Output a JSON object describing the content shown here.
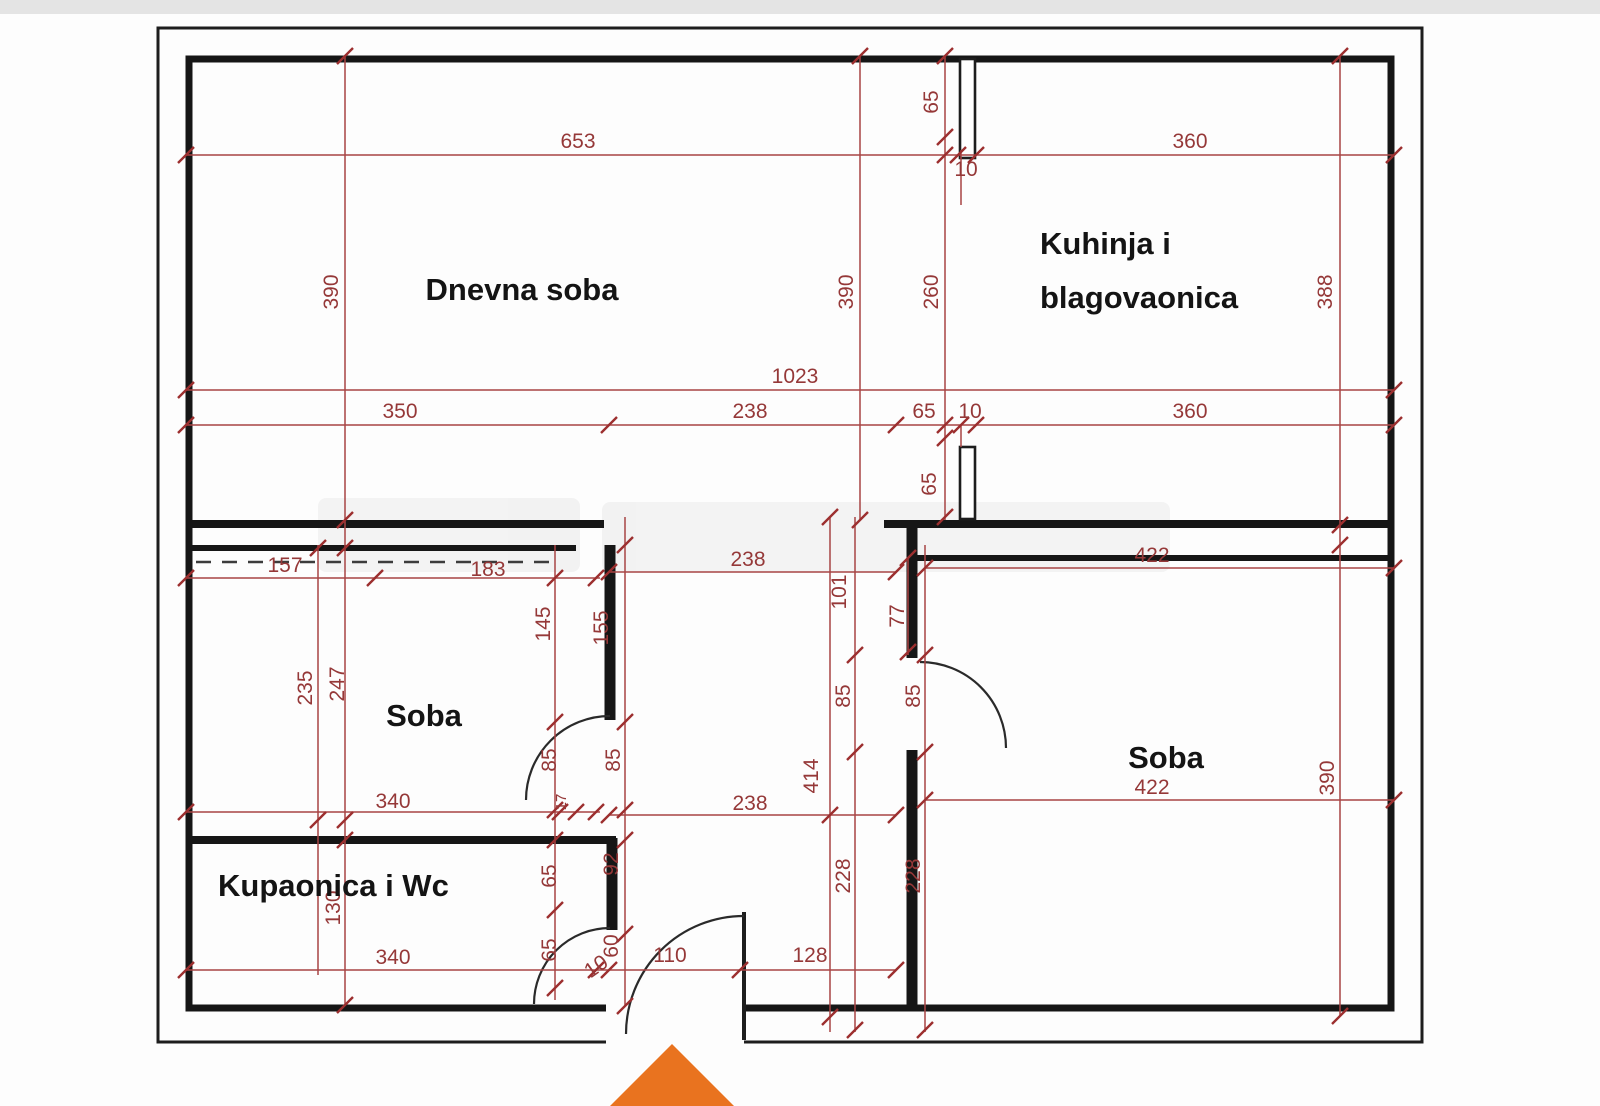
{
  "rooms": {
    "living": "Dnevna soba",
    "kitchen_line1": "Kuhinja i",
    "kitchen_line2": "blagovaonica",
    "room_left": "Soba",
    "room_right": "Soba",
    "bathroom": "Kupaonica i Wc"
  },
  "dimensions": {
    "top_row": {
      "left": "653",
      "right": "360",
      "vent_h": "65",
      "vent_w": "10"
    },
    "upper_heights": {
      "left": "390",
      "mid": "390",
      "kitchen": "260",
      "right": "388"
    },
    "mid_row": {
      "total": "1023",
      "a": "350",
      "b": "238",
      "c": "65",
      "d": "10",
      "e": "360",
      "vent2_h": "65"
    },
    "lower_top_row": {
      "a": "157",
      "b": "183",
      "c": "238",
      "d": "422",
      "hall": "101",
      "wall": "77"
    },
    "left_room": {
      "wall_a": "145",
      "wall_b": "155",
      "h1": "235",
      "h2": "247",
      "door_a": "85",
      "door_b": "85"
    },
    "hall": {
      "len": "414",
      "door_a": "85",
      "door_b": "85"
    },
    "lower_mid_row": {
      "a": "340",
      "b": "17",
      "c": "238",
      "d": "422"
    },
    "right_room": {
      "height": "390",
      "w228a": "228",
      "w228b": "228"
    },
    "bath": {
      "h": "130",
      "w65a": "65",
      "w92": "92",
      "w65b": "65",
      "w60": "60"
    },
    "bottom_row": {
      "a": "340",
      "b": "10",
      "c": "110",
      "d": "128"
    }
  },
  "colors": {
    "dimension": "#9c2f2f",
    "wall": "#161616",
    "entrance_arrow": "#e9731f"
  }
}
